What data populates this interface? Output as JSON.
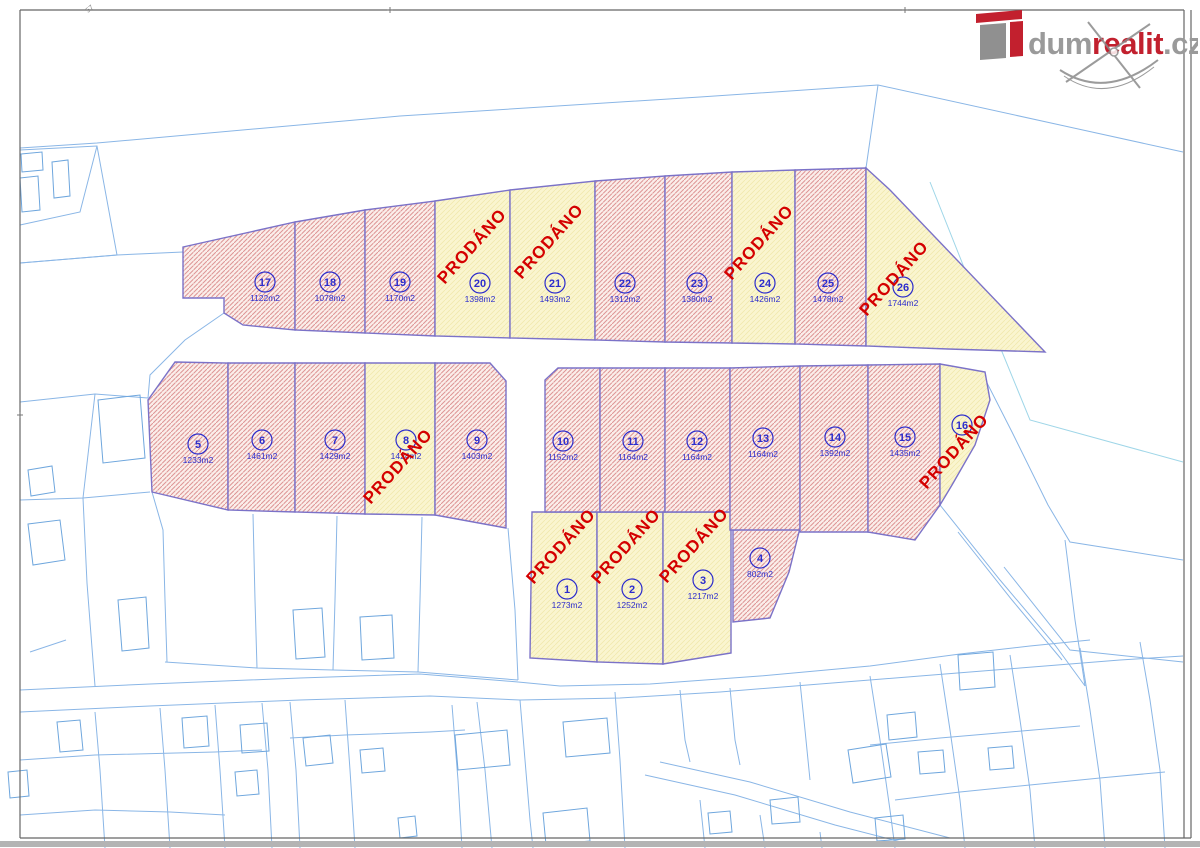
{
  "logo": {
    "dum": "dum",
    "realit": "realit",
    "cz": ".cz"
  },
  "sold_label": "PRODÁNO",
  "watermark_text": "dumrealit.cz",
  "frame_mark": "57",
  "colors": {
    "sold_red": "#d40000",
    "plot_outline": "#7b72c8",
    "label_blue": "#2d2dcc",
    "parcel_blue": "#4a8fd6",
    "pink_fill": "#fbeeea",
    "pink_hatch": "#dd9494",
    "yellow_fill": "#faf5cf",
    "logo_red": "#c2202e",
    "logo_gray": "#9a9a9a"
  },
  "plots": [
    {
      "n": "1",
      "a": "1273m2",
      "s": true,
      "p": "532,512 597,512 597,662 530,658",
      "lx": 567,
      "ly": 589,
      "px": 565,
      "py": 550
    },
    {
      "n": "2",
      "a": "1252m2",
      "s": true,
      "p": "597,512 663,512 663,664 597,662",
      "lx": 632,
      "ly": 589,
      "px": 630,
      "py": 550
    },
    {
      "n": "3",
      "a": "1217m2",
      "s": true,
      "p": "663,512 731,512 731,653 663,664",
      "lx": 703,
      "ly": 580,
      "px": 698,
      "py": 549
    },
    {
      "n": "4",
      "a": "802m2",
      "s": false,
      "p": "733,530 800,528 789,572 770,618 733,622",
      "lx": 760,
      "ly": 558
    },
    {
      "n": "5",
      "a": "1233m2",
      "s": false,
      "p": "175,362 228,363 228,510 152,492 148,400",
      "lx": 198,
      "ly": 444
    },
    {
      "n": "6",
      "a": "1461m2",
      "s": false,
      "p": "228,363 295,363 295,512 228,510",
      "lx": 262,
      "ly": 440
    },
    {
      "n": "7",
      "a": "1429m2",
      "s": false,
      "p": "295,363 365,363 365,514 295,512",
      "lx": 335,
      "ly": 440
    },
    {
      "n": "8",
      "a": "1424m2",
      "s": true,
      "p": "365,363 435,363 435,515 365,514",
      "lx": 406,
      "ly": 440,
      "px": 402,
      "py": 470
    },
    {
      "n": "9",
      "a": "1403m2",
      "s": false,
      "p": "435,363 490,363 506,381 506,528 435,515",
      "lx": 477,
      "ly": 440
    },
    {
      "n": "10",
      "a": "1152m2",
      "s": false,
      "p": "545,380 558,368 600,368 600,512 545,512",
      "lx": 563,
      "ly": 441
    },
    {
      "n": "11",
      "a": "1164m2",
      "s": false,
      "p": "600,368 665,368 665,512 600,512",
      "lx": 633,
      "ly": 441
    },
    {
      "n": "12",
      "a": "1164m2",
      "s": false,
      "p": "665,368 730,368 730,512 665,512",
      "lx": 697,
      "ly": 441
    },
    {
      "n": "13",
      "a": "1164m2",
      "s": false,
      "p": "730,368 800,366 800,530 730,530",
      "lx": 763,
      "ly": 438
    },
    {
      "n": "14",
      "a": "1392m2",
      "s": false,
      "p": "800,366 868,365 868,532 800,532",
      "lx": 835,
      "ly": 437
    },
    {
      "n": "15",
      "a": "1435m2",
      "s": false,
      "p": "868,365 940,364 940,505 915,540 868,532",
      "lx": 905,
      "ly": 437
    },
    {
      "n": "16",
      "a": "",
      "s": true,
      "p": "940,364 985,372 990,400 975,445 952,485 940,505",
      "lx": 962,
      "ly": 425,
      "px": 958,
      "py": 455
    },
    {
      "n": "17",
      "a": "1122m2",
      "s": false,
      "p": "183,247 295,222 295,330 243,325 224,313 224,298 183,298",
      "lx": 265,
      "ly": 282
    },
    {
      "n": "18",
      "a": "1078m2",
      "s": false,
      "p": "295,222 365,210 365,333 295,330",
      "lx": 330,
      "ly": 282
    },
    {
      "n": "19",
      "a": "1170m2",
      "s": false,
      "p": "365,210 435,201 435,336 365,333",
      "lx": 400,
      "ly": 282
    },
    {
      "n": "20",
      "a": "1398m2",
      "s": true,
      "p": "435,201 510,190 510,338 435,336",
      "lx": 480,
      "ly": 283,
      "px": 476,
      "py": 250
    },
    {
      "n": "21",
      "a": "1493m2",
      "s": true,
      "p": "510,190 595,181 595,340 510,338",
      "lx": 555,
      "ly": 283,
      "px": 553,
      "py": 245
    },
    {
      "n": "22",
      "a": "1312m2",
      "s": false,
      "p": "595,181 665,176 665,342 595,340",
      "lx": 625,
      "ly": 283
    },
    {
      "n": "23",
      "a": "1380m2",
      "s": false,
      "p": "665,176 732,172 732,343 665,342",
      "lx": 697,
      "ly": 283
    },
    {
      "n": "24",
      "a": "1426m2",
      "s": true,
      "p": "732,172 795,170 795,344 732,343",
      "lx": 765,
      "ly": 283,
      "px": 763,
      "py": 246
    },
    {
      "n": "25",
      "a": "1478m2",
      "s": false,
      "p": "795,170 866,168 866,346 795,344",
      "lx": 828,
      "ly": 283
    },
    {
      "n": "26",
      "a": "1744m2",
      "s": true,
      "p": "866,168 890,190 1045,352 948,349 866,346",
      "lx": 903,
      "ly": 287,
      "px": 898,
      "py": 282
    }
  ],
  "parcel_labels": [
    {
      "t": "1933/2",
      "x": 405,
      "y": 105,
      "r": 55
    },
    {
      "t": "2067/1",
      "x": 1002,
      "y": 237,
      "r": 72
    },
    {
      "t": "1992/1",
      "x": 957,
      "y": 330,
      "r": 65
    },
    {
      "t": "417",
      "x": 14,
      "y": 163,
      "r": 55
    },
    {
      "t": "412",
      "x": 60,
      "y": 180,
      "r": 55
    },
    {
      "t": "1946/3",
      "x": 40,
      "y": 202,
      "r": 55
    },
    {
      "t": "1946/2",
      "x": 72,
      "y": 238,
      "r": 55
    },
    {
      "t": "1936/2",
      "x": 33,
      "y": 307,
      "r": 55
    },
    {
      "t": "2823",
      "x": 85,
      "y": 395,
      "r": 55
    },
    {
      "t": "328",
      "x": 117,
      "y": 430,
      "r": 55
    },
    {
      "t": "442",
      "x": 38,
      "y": 478,
      "r": 55
    },
    {
      "t": "1938/1",
      "x": 113,
      "y": 484,
      "r": 55
    },
    {
      "t": "268",
      "x": 44,
      "y": 546,
      "r": 55
    },
    {
      "t": "1936",
      "x": 136,
      "y": 577,
      "r": 55
    },
    {
      "t": "1927/1",
      "x": 60,
      "y": 593,
      "r": 55
    },
    {
      "t": "1973/4",
      "x": 106,
      "y": 608,
      "r": 55
    },
    {
      "t": "457",
      "x": 127,
      "y": 631,
      "r": 55
    },
    {
      "t": "2744/1",
      "x": 60,
      "y": 634,
      "r": 0
    },
    {
      "t": "1927/2",
      "x": 65,
      "y": 651,
      "r": 55
    },
    {
      "t": "1933/7",
      "x": 208,
      "y": 597,
      "r": 55
    },
    {
      "t": "1933/8",
      "x": 291,
      "y": 574,
      "r": 55
    },
    {
      "t": "1933/10",
      "x": 378,
      "y": 598,
      "r": 55
    },
    {
      "t": "473",
      "x": 308,
      "y": 638,
      "r": 55
    },
    {
      "t": "470",
      "x": 370,
      "y": 638,
      "r": 55
    },
    {
      "t": "1933/11",
      "x": 466,
      "y": 598,
      "r": 55
    },
    {
      "t": "1933/5",
      "x": 468,
      "y": 686,
      "r": 0
    },
    {
      "t": "1973/1",
      "x": 217,
      "y": 682,
      "r": 0
    },
    {
      "t": "1927/3",
      "x": 85,
      "y": 688,
      "r": 0
    },
    {
      "t": "320/2",
      "x": 41,
      "y": 740,
      "r": 55
    },
    {
      "t": "320/4",
      "x": 64,
      "y": 737,
      "r": 55
    },
    {
      "t": "1973/3",
      "x": 136,
      "y": 730,
      "r": 55
    },
    {
      "t": "264/1",
      "x": 198,
      "y": 738,
      "r": 55
    },
    {
      "t": "1934/3",
      "x": 190,
      "y": 754,
      "r": 0
    },
    {
      "t": "1935/4",
      "x": 223,
      "y": 732,
      "r": 55
    },
    {
      "t": "420",
      "x": 255,
      "y": 740,
      "r": 55
    },
    {
      "t": "1935/2",
      "x": 278,
      "y": 745,
      "r": 55
    },
    {
      "t": "435",
      "x": 14,
      "y": 788,
      "r": 55
    },
    {
      "t": "1925/3",
      "x": 62,
      "y": 786,
      "r": 55
    },
    {
      "t": "1934/1",
      "x": 129,
      "y": 795,
      "r": 55
    },
    {
      "t": "1934/2",
      "x": 186,
      "y": 796,
      "r": 55
    },
    {
      "t": "406",
      "x": 244,
      "y": 783,
      "r": 55
    },
    {
      "t": "1935/3",
      "x": 227,
      "y": 810,
      "r": 55
    },
    {
      "t": "2746",
      "x": 269,
      "y": 813,
      "r": 55
    },
    {
      "t": "1925/1",
      "x": 47,
      "y": 838,
      "r": 0
    },
    {
      "t": "2744/1",
      "x": 371,
      "y": 732,
      "r": 0
    },
    {
      "t": "2744/2",
      "x": 443,
      "y": 733,
      "r": 0
    },
    {
      "t": "1933/34",
      "x": 481,
      "y": 728,
      "r": 0
    },
    {
      "t": "2799/2",
      "x": 514,
      "y": 715,
      "r": 0
    },
    {
      "t": "1933/33",
      "x": 550,
      "y": 714,
      "r": 0
    },
    {
      "t": "262/2",
      "x": 314,
      "y": 752,
      "r": 55
    },
    {
      "t": "262/1",
      "x": 372,
      "y": 763,
      "r": 55
    },
    {
      "t": "1978",
      "x": 416,
      "y": 755,
      "r": 0
    },
    {
      "t": "261",
      "x": 484,
      "y": 752,
      "r": 55
    },
    {
      "t": "1991",
      "x": 586,
      "y": 740,
      "r": 55
    },
    {
      "t": "1986/2",
      "x": 554,
      "y": 768,
      "r": 55
    },
    {
      "t": "2747/2",
      "x": 398,
      "y": 783,
      "r": 55
    },
    {
      "t": "1976/2",
      "x": 439,
      "y": 785,
      "r": 55
    },
    {
      "t": "1973/2",
      "x": 306,
      "y": 790,
      "r": 55
    },
    {
      "t": "1974/1",
      "x": 361,
      "y": 810,
      "r": 55
    },
    {
      "t": "1989",
      "x": 381,
      "y": 822,
      "r": 55
    },
    {
      "t": "1976/3",
      "x": 424,
      "y": 813,
      "r": 55
    },
    {
      "t": "1976/1",
      "x": 483,
      "y": 820,
      "r": 55
    },
    {
      "t": "263",
      "x": 314,
      "y": 828,
      "r": 55
    },
    {
      "t": "280",
      "x": 568,
      "y": 828,
      "r": 55
    },
    {
      "t": "1985",
      "x": 659,
      "y": 725,
      "r": 55
    },
    {
      "t": "1992/3",
      "x": 701,
      "y": 730,
      "r": 55
    },
    {
      "t": "1992/5",
      "x": 761,
      "y": 705,
      "r": 55
    },
    {
      "t": "1992/10",
      "x": 746,
      "y": 750,
      "r": 55
    },
    {
      "t": "1992/4",
      "x": 849,
      "y": 705,
      "r": 55
    },
    {
      "t": "1950",
      "x": 901,
      "y": 725,
      "r": 55
    },
    {
      "t": "398",
      "x": 871,
      "y": 763,
      "r": 55
    },
    {
      "t": "347",
      "x": 926,
      "y": 770,
      "r": 55
    },
    {
      "t": "1989/8",
      "x": 704,
      "y": 795,
      "r": 55
    },
    {
      "t": "1989/9",
      "x": 756,
      "y": 784,
      "r": 0
    },
    {
      "t": "404",
      "x": 776,
      "y": 798,
      "r": 55
    },
    {
      "t": "1948",
      "x": 719,
      "y": 823,
      "r": 0
    },
    {
      "t": "258",
      "x": 789,
      "y": 835,
      "r": 55
    },
    {
      "t": "1989/1",
      "x": 844,
      "y": 826,
      "r": 55
    },
    {
      "t": "314",
      "x": 886,
      "y": 825,
      "r": 55
    },
    {
      "t": "1986/4",
      "x": 668,
      "y": 805,
      "r": 75
    },
    {
      "t": "1933/4",
      "x": 849,
      "y": 603,
      "r": 55
    },
    {
      "t": "2799/1",
      "x": 823,
      "y": 672,
      "r": 0
    },
    {
      "t": "1996/1",
      "x": 1111,
      "y": 455,
      "r": 55
    },
    {
      "t": "1992/9",
      "x": 988,
      "y": 520,
      "r": 55
    },
    {
      "t": "1992/6",
      "x": 964,
      "y": 580,
      "r": 55
    },
    {
      "t": "1992/7",
      "x": 996,
      "y": 610,
      "r": 55
    },
    {
      "t": "1992/2",
      "x": 959,
      "y": 635,
      "r": 55
    },
    {
      "t": "1986/5",
      "x": 1014,
      "y": 650,
      "r": 55
    },
    {
      "t": "1930",
      "x": 969,
      "y": 673,
      "r": 55
    },
    {
      "t": "1995/1",
      "x": 1118,
      "y": 650,
      "r": 55
    },
    {
      "t": "1995/4",
      "x": 1053,
      "y": 685,
      "r": 55
    },
    {
      "t": "1996/4",
      "x": 1031,
      "y": 700,
      "r": 55
    },
    {
      "t": "250",
      "x": 1002,
      "y": 763,
      "r": 55
    },
    {
      "t": "1995/2",
      "x": 1162,
      "y": 630,
      "r": 55
    },
    {
      "t": "1996/2",
      "x": 1130,
      "y": 790,
      "r": 55
    },
    {
      "t": "1996/8",
      "x": 937,
      "y": 747,
      "r": 55
    }
  ],
  "gray_labels": [
    {
      "t": "1933/3",
      "x": 462,
      "y": 425,
      "r": 0
    }
  ],
  "lines": [
    "20,148 97,143 400,116 700,97 878,85",
    "878,85 866,168",
    "878,85 1183,152",
    "983,375 1012,432 1048,505 1070,542 1183,560",
    "20,150 97,146 117,255 20,263",
    "97,146 80,212 20,225",
    "20,263 117,255 183,252",
    "20,402 95,394 148,398",
    "95,394 83,498",
    "20,500 83,498 150,492",
    "152,492 163,530 165,600 167,662",
    "83,498 87,583 92,648 95,686",
    "253,514 255,600 257,668",
    "337,516 335,600 333,670",
    "422,517 420,600 418,672",
    "508,528 515,610 518,680",
    "165,662 257,668 333,670 418,672 518,680",
    "20,690 150,684 300,678 420,674 518,682 560,686 650,684 760,676 870,666 960,654 1030,646 1090,640",
    "20,712 150,706 300,700 430,696 520,700 620,698 720,692 820,684 920,676 1020,668 1120,660 1183,656",
    "660,762 750,782 850,812 950,838",
    "645,775 735,795 835,825 905,843",
    "477,702 485,770 492,848",
    "95,712 100,770 105,848",
    "160,708 165,770 170,848",
    "215,705 220,770 225,848",
    "262,703 268,770 272,848",
    "20,760 95,755 215,752 262,750",
    "20,815 95,810 170,812 225,815",
    "290,702 296,770 300,848",
    "345,700 350,770 355,848",
    "452,705 458,780 462,848",
    "290,738 345,735 430,732 465,730",
    "520,700 525,760 530,820 533,848",
    "615,692 620,760 625,848",
    "680,690 685,740 690,762",
    "730,688 735,740 740,765",
    "800,682 805,730 810,780",
    "700,800 705,848",
    "760,815 765,848",
    "820,832 822,848",
    "940,505 1000,580 1055,645 1085,686",
    "958,532 1012,600 1062,660",
    "1065,540 1075,620 1085,686",
    "870,676 880,740 890,810 895,848",
    "940,664 950,730 960,800 965,848",
    "1010,655 1020,720 1030,790 1035,848",
    "1080,648 1090,710 1100,780 1105,848",
    "1140,642 1150,700 1160,770 1165,848",
    "870,745 940,738 1010,732 1080,726",
    "895,800 960,792 1030,785 1100,778 1165,772",
    "224,313 185,340 150,375 148,398",
    "1004,567 1070,650 1183,662",
    "30,652 66,640"
  ],
  "cyan_lines": [
    "930,182 973,290 998,342 1030,420 1183,462"
  ],
  "buildings": [
    "52,162 68,160 70,196 54,198",
    "20,178 38,176 40,210 22,212",
    "21,154 42,152 43,170 22,172",
    "98,400 140,395 145,458 103,463",
    "28,470 52,466 55,492 31,496",
    "28,524 60,520 65,560 33,565",
    "118,600 146,597 149,648 122,651",
    "293,610 322,608 325,657 296,659",
    "360,617 392,615 394,658 362,660",
    "57,722 80,720 83,750 60,752",
    "182,718 207,716 209,746 184,748",
    "240,725 267,723 269,751 242,753",
    "235,772 257,770 259,794 237,796",
    "8,772 27,770 29,796 10,798",
    "303,738 330,735 333,763 306,766",
    "360,750 383,748 385,771 362,773",
    "455,735 507,730 510,765 458,770",
    "563,722 607,718 610,753 566,757",
    "543,813 587,808 590,841 546,845",
    "398,818 415,816 417,836 400,838",
    "708,813 730,811 732,832 710,834",
    "848,750 886,744 891,777 853,783",
    "887,715 915,712 917,737 889,740",
    "875,818 903,815 905,839 877,841",
    "958,655 993,652 995,687 960,690",
    "918,752 943,750 945,772 920,774",
    "988,748 1012,746 1014,768 990,770",
    "770,800 798,797 800,822 772,824"
  ]
}
